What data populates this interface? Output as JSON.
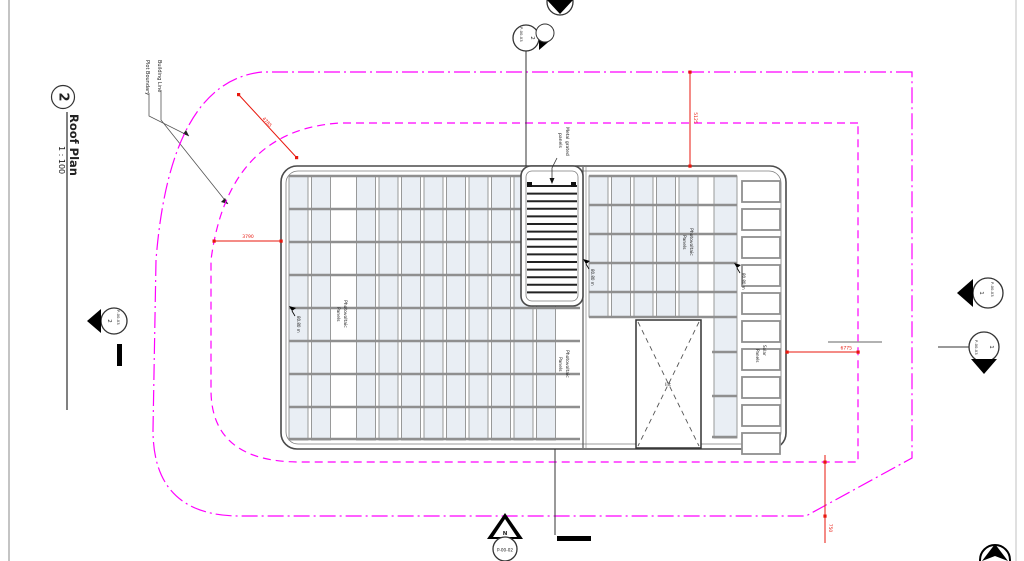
{
  "sheet": {
    "view_number": "2",
    "view_name": "Roof Plan",
    "view_scale": "1 : 100"
  },
  "legend": {
    "plot_boundary": "Plot Boundary",
    "building_line": "Building Line"
  },
  "labels": {
    "metal_grated_1": "Metal grated",
    "metal_grated_2": "panels",
    "photovoltaic_1": "Photovoltaic",
    "photovoltaic_2": "Panels",
    "solar_1": "Solar",
    "solar_2": "Panels",
    "lift": "lift",
    "spot_elevation": "80.80 m"
  },
  "dims": {
    "plot_diagonal": "4785",
    "left_setback": "3790",
    "top_setback": "5125",
    "right_setback": "6775",
    "bottom_setback": "750"
  },
  "markers": {
    "section_top": {
      "number": "2",
      "sheet": "P-00-03"
    },
    "section_left": {
      "number": "2",
      "sheet": "P-00-03"
    },
    "section_right_upper": {
      "number": "1",
      "sheet": "P-00-03"
    },
    "section_right_lower": {
      "number": "1",
      "sheet": "P-00-03"
    },
    "elevation_bottom": {
      "letter": "N",
      "sheet": "P-00-02"
    }
  },
  "colors": {
    "boundary_magenta": "#ff00ff",
    "dimension_red": "#e8170d",
    "panel_fill": "#e9eef4",
    "panel_frame": "#8f8f8f",
    "outline_gray": "#4a4a4a"
  }
}
